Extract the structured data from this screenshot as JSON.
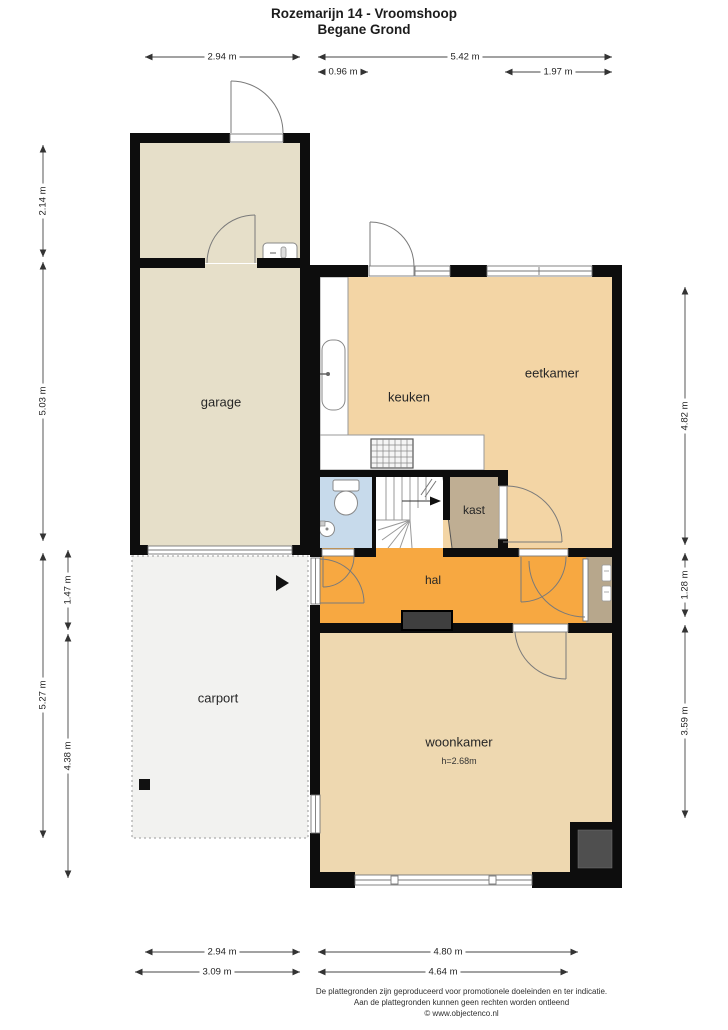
{
  "title": {
    "line1": "Rozemarijn 14 - Vroomshoop",
    "line2": "Begane Grond"
  },
  "rooms": {
    "garage": "garage",
    "carport": "carport",
    "keuken": "keuken",
    "eetkamer": "eetkamer",
    "kast": "kast",
    "hal": "hal",
    "woonkamer": "woonkamer",
    "woonkamer_ceiling_height": "h=2.68m"
  },
  "dimensions": {
    "top": {
      "d294": "2.94 m",
      "d542": "5.42 m",
      "d096": "0.96 m",
      "d197": "1.97 m"
    },
    "left": {
      "d214": "2.14 m",
      "d503": "5.03 m",
      "d527": "5.27 m",
      "d147": "1.47 m",
      "d438": "4.38 m"
    },
    "right": {
      "d482": "4.82 m",
      "d128": "1.28 m",
      "d359": "3.59 m"
    },
    "bottom": {
      "d294": "2.94 m",
      "d480": "4.80 m",
      "d309": "3.09 m",
      "d464": "4.64 m"
    }
  },
  "footer": {
    "line1": "De plattegronden zijn geproduceerd voor promotionele doeleinden en ter indicatie.",
    "line2": "Aan de plattegronden kunnen geen rechten worden ontleend",
    "line3": "© www.objectenco.nl"
  },
  "colors": {
    "wall": "#0d0d0d",
    "garage_fill": "#e6dfc9",
    "kitchen_dining_fill": "#f3d5a5",
    "living_fill": "#eed8b0",
    "hall_fill": "#f7a841",
    "closet_fill": "#bfae93",
    "porch_fill": "#b7a78c",
    "toilet_fill": "#c7daeb",
    "carport_fill": "#f2f2f0",
    "doormat_fill": "#3f3f3f",
    "fireplace_fill": "#4f4f4f"
  }
}
